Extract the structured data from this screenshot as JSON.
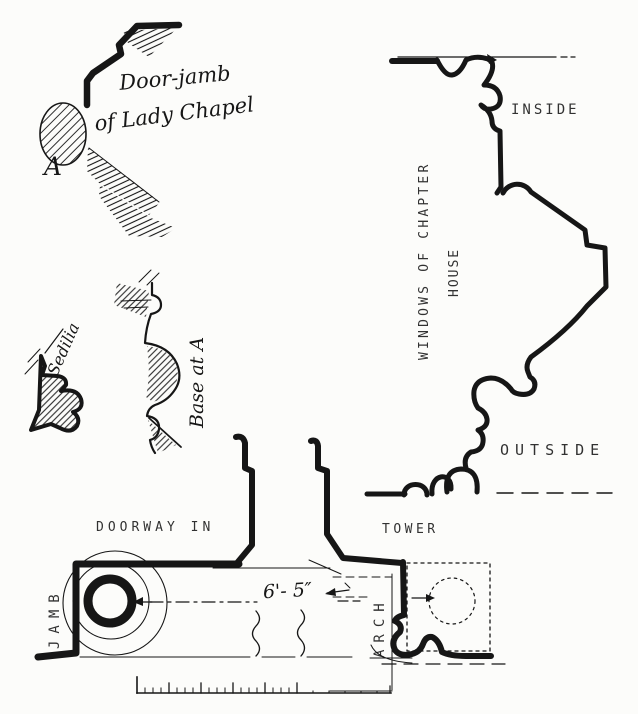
{
  "colors": {
    "ink": "#161616",
    "paper": "#fcfcfa"
  },
  "labels": {
    "door_jamb_line1": "Door-jamb",
    "door_jamb_line2": "of Lady Chapel",
    "point_a": "A",
    "sedilia": "Sedilia",
    "base_at_a": "Base at A",
    "windows_line1": "WINDOWS OF CHAPTER",
    "windows_line2": "HOUSE",
    "inside": "INSIDE",
    "outside": "OUTSIDE",
    "doorway_in": "DOORWAY IN",
    "tower": "TOWER",
    "jamb": "JAMB",
    "arch": "ARCH",
    "dimension": "6'- 5″"
  }
}
